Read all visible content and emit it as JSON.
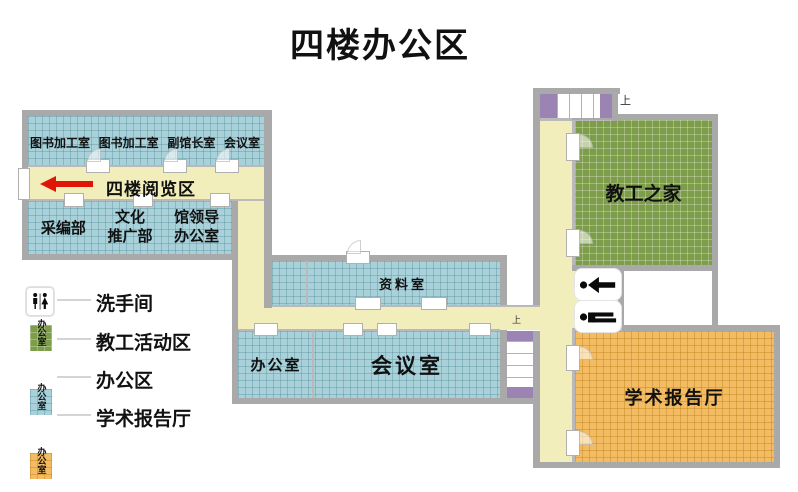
{
  "title": "四楼办公区",
  "plan": {
    "corridor_label": "四楼阅览区",
    "stairs_top_up": "上",
    "stairs_mid_up": "上",
    "rooms": {
      "top_row": [
        "图书加工室",
        "图书加工室",
        "副馆长室",
        "会议室"
      ],
      "catalog": "采编部",
      "culture": [
        "文化",
        "推广部"
      ],
      "leadership": [
        "馆领导",
        "办公室"
      ],
      "reference": "资料室",
      "office": "办公室",
      "meeting": "会议室",
      "staff_home": "教工之家",
      "lecture_hall": "学术报告厅"
    }
  },
  "legend": {
    "restroom_label": "洗手间",
    "items": [
      {
        "label": "教工活动区",
        "swatch_text": "办公室",
        "color": "#7d9d4b"
      },
      {
        "label": "办公区",
        "swatch_text": "办公室",
        "color": "#a9d1da"
      },
      {
        "label": "学术报告厅",
        "swatch_text": "办公室",
        "color": "#f3bc62"
      }
    ]
  },
  "colors": {
    "office_blue": "#a9d1da",
    "staff_green": "#7d9d4b",
    "lecture_orange": "#f3bc62",
    "corridor_yellow": "#f2eebb",
    "wall_gray": "#a9a9a9",
    "stair_purple": "#9b84b4",
    "arrow_red": "#e01505"
  }
}
